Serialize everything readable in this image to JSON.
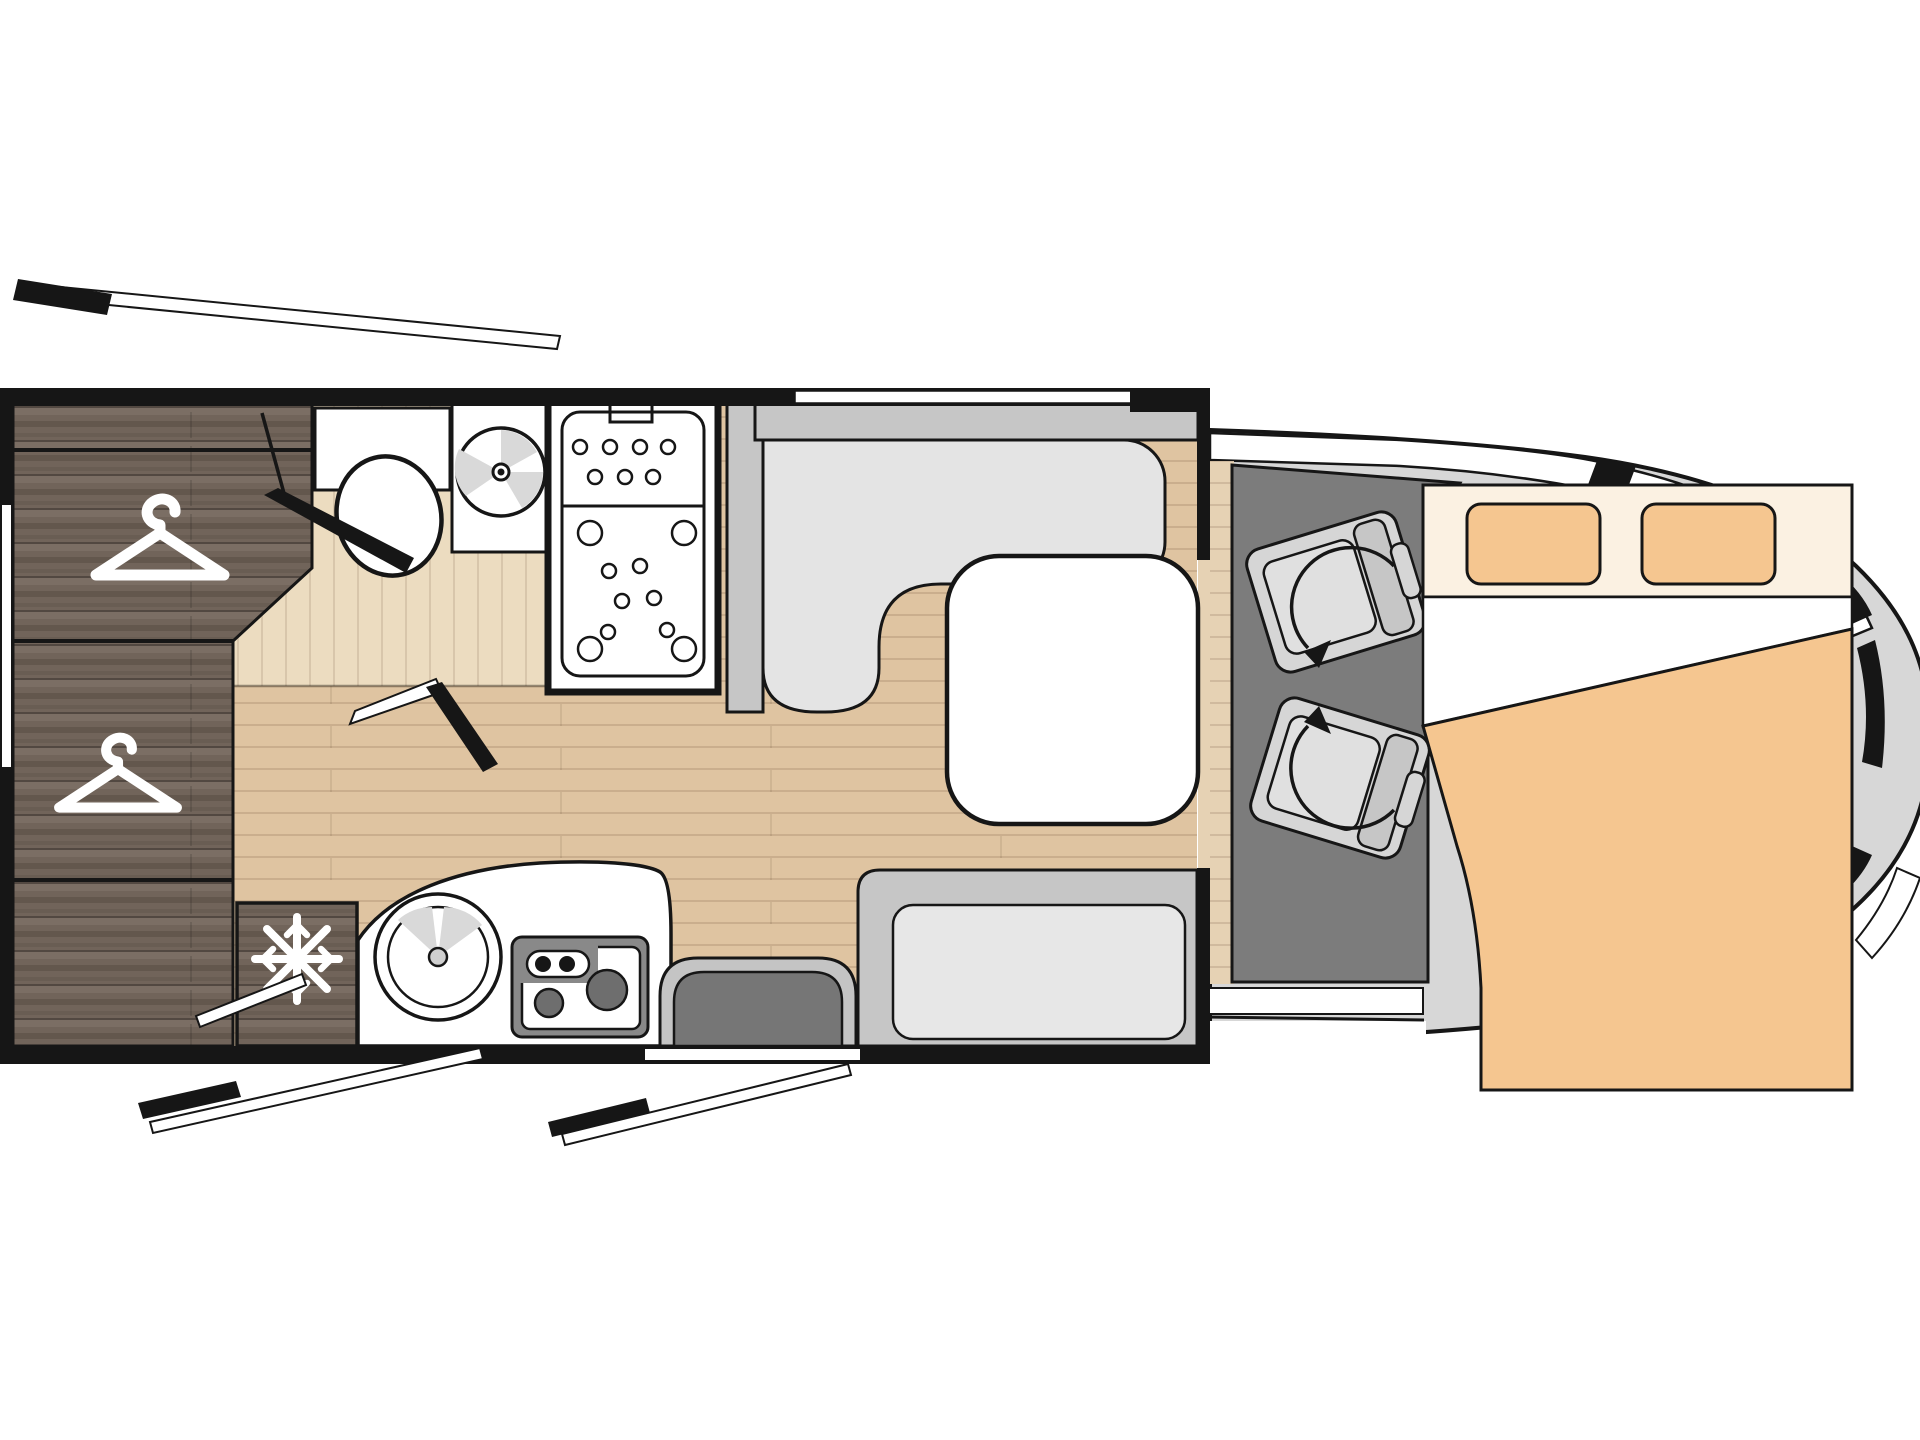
{
  "diagram": {
    "type": "motorhome-floorplan-top-view",
    "vehicle": "coachbuilt camper van floor plan",
    "colors": {
      "outline": "#161616",
      "wood_base": "#71645a",
      "wood_dark": "#584c42",
      "wood_light": "#83766b",
      "floor": "#dfc4a1",
      "floor_bath": "#ecdcc0",
      "floor_step": "#e6d2b4",
      "cab_floor": "#7c7c7c",
      "body_gray": "#d7d7d7",
      "seat_gray": "#d6d6d6",
      "seat_cushion": "#e0e0e0",
      "sofa_back": "#c6c6c6",
      "sofa_seat": "#e4e4e4",
      "bench_cushion": "#e7e7e7",
      "door_rim": "#c4c4c4",
      "door_dark": "#767676",
      "stove_bezel": "#898989",
      "burner": "#6e6e6e",
      "wedge_gray": "#d9d9d9",
      "bed_head": "#fbf1e2",
      "bed_pillow": "#f5c690",
      "bed_blanket": "#f5c690",
      "white": "#ffffff"
    },
    "zones": [
      {
        "id": "rear-wardrobe",
        "icon": "hanger-icon",
        "icon_count": 2
      },
      {
        "id": "bathroom",
        "fixtures": [
          "toilet",
          "washbasin",
          "shower"
        ]
      },
      {
        "id": "kitchen",
        "fixtures": [
          "round-sink",
          "two-burner-stove",
          "fridge"
        ],
        "icon": "snowflake-icon"
      },
      {
        "id": "dinette",
        "fixtures": [
          "l-shaped-sofa",
          "table",
          "bench-seat"
        ]
      },
      {
        "id": "cab",
        "fixtures": [
          "driver-swivel-seat",
          "passenger-swivel-seat"
        ],
        "icon": "rotate-arrow-icon"
      },
      {
        "id": "drop-down-bed",
        "fixtures": [
          "pillow",
          "pillow",
          "sheet",
          "blanket"
        ]
      }
    ],
    "doors": [
      {
        "id": "entry-door",
        "state": "open-swing-shown"
      },
      {
        "id": "bathroom-door",
        "state": "open"
      },
      {
        "id": "rear-hatch",
        "state": "open-swing-shown"
      },
      {
        "id": "garage-hatch",
        "state": "open-swing-shown"
      }
    ]
  }
}
